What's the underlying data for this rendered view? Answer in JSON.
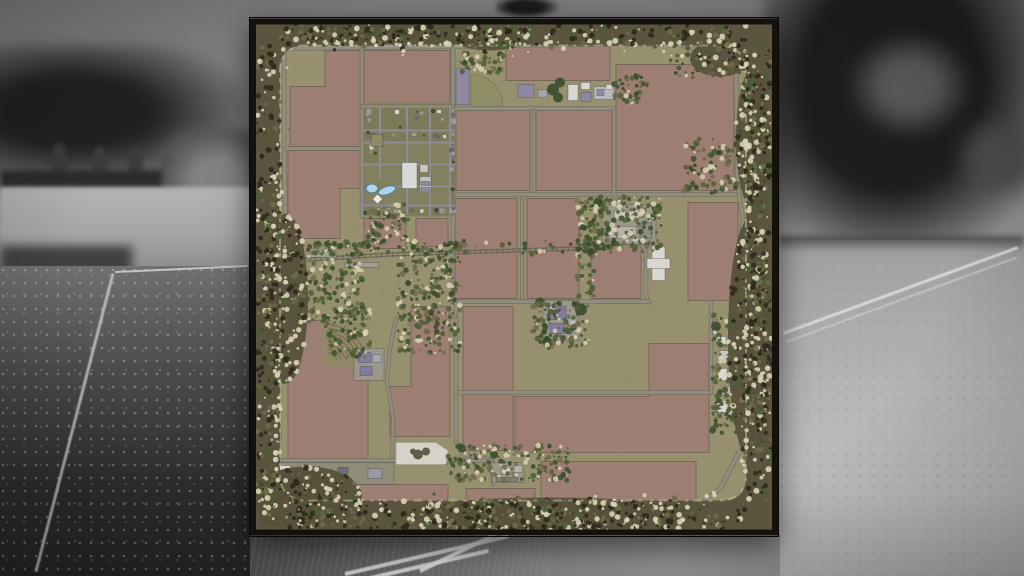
{
  "scene": {
    "type": "farming-simulator-map-preview",
    "background_photo": "grayscale countryside with trees, white fences and meadow",
    "visible_text": []
  },
  "map": {
    "colors": {
      "frame": "#15120e",
      "terrain": "#97906e",
      "field": "#9c7e72",
      "field_stroke": "#6e5f55",
      "road": "#908d80",
      "road_casing": "#6f6b5a",
      "street": "#8d8c96",
      "ring_base": "#57513c",
      "ring_dark": "#2f2a1c",
      "ring_green": "#4d5e34",
      "ring_olive": "#6e6a4a",
      "ring_cream": "#d8d2b4",
      "fringe": "#cfc9ac",
      "village_block": "#7c7a59",
      "pond": "#a9d6ea",
      "pond_stroke": "#557a8c",
      "forest": "#3a472a",
      "tree": "#3d5030",
      "quarry": "#d5d3c9",
      "quarry_blob": "#5f5b45",
      "pie_field": "#8f8e66",
      "rail": "#6b685c"
    },
    "frame": {
      "w": 528,
      "h": 517,
      "border": 6
    },
    "ring": {
      "inner": [
        30,
        27,
        466,
        455,
        24
      ],
      "band": {
        "t": 20,
        "r": 26,
        "b": 29,
        "l": 23
      },
      "speckles": 1150,
      "bulges": [
        [
          36,
          280,
          22,
          85
        ],
        [
          240,
          20,
          36,
          12
        ],
        [
          500,
          320,
          22,
          120
        ],
        [
          300,
          496,
          150,
          17
        ],
        [
          56,
          478,
          56,
          30
        ],
        [
          503,
          120,
          17,
          70
        ],
        [
          110,
          16,
          60,
          10
        ],
        [
          470,
          40,
          30,
          18
        ]
      ]
    },
    "fields": [
      {
        "pts": "75,32 112,32 112,128 40,128 40,68 75,68"
      },
      {
        "pts": "38,132 112,132 112,170 90,170 90,220 38,220"
      },
      {
        "rect": [
          114,
          32,
          86,
          54
        ]
      },
      {
        "rect": [
          256,
          28,
          104,
          34
        ]
      },
      {
        "rect": [
          366,
          46,
          118,
          126
        ]
      },
      {
        "rect": [
          206,
          92,
          74,
          80
        ]
      },
      {
        "rect": [
          286,
          92,
          76,
          80
        ]
      },
      {
        "rect": [
          114,
          200,
          42,
          30
        ]
      },
      {
        "rect": [
          166,
          200,
          32,
          28
        ]
      },
      {
        "rect": [
          205,
          180,
          62,
          100
        ]
      },
      {
        "rect": [
          277,
          180,
          52,
          100
        ]
      },
      {
        "rect": [
          341,
          226,
          50,
          54
        ]
      },
      {
        "rect": [
          438,
          184,
          50,
          98
        ]
      },
      {
        "pts": "38,302 80,302 80,326 118,326 118,445 38,445"
      },
      {
        "pts": "161,288 200,288 200,418 140,418 140,368 161,368"
      },
      {
        "rect": [
          213,
          288,
          50,
          144
        ]
      },
      {
        "rect": [
          96,
          466,
          102,
          24
        ]
      },
      {
        "rect": [
          216,
          470,
          69,
          22
        ]
      },
      {
        "pts": "399,325 459,325 459,434 265,434 265,378 399,378"
      },
      {
        "rect": [
          291,
          443,
          155,
          42
        ]
      }
    ],
    "pie_field": "M221,88 L221,56 A32,32 0 0 1 253,88 Z",
    "roads": [
      {
        "p": [
          [
            32,
            30
          ],
          [
            204,
            28
          ],
          [
            364,
            25
          ]
        ],
        "w": 3.4
      },
      {
        "p": [
          [
            364,
            25
          ],
          [
            430,
            26
          ],
          [
            470,
            38
          ],
          [
            486,
            54
          ],
          [
            488,
            170
          ]
        ],
        "w": 3.4
      },
      {
        "p": [
          [
            34,
            30
          ],
          [
            34,
            130
          ],
          [
            36,
            222
          ]
        ],
        "w": 3.4
      },
      {
        "p": [
          [
            36,
            130
          ],
          [
            112,
            130
          ]
        ],
        "w": 3
      },
      {
        "p": [
          [
            112,
            30
          ],
          [
            112,
            198
          ]
        ],
        "w": 3
      },
      {
        "p": [
          [
            203,
            30
          ],
          [
            203,
            284
          ]
        ],
        "w": 3.2
      },
      {
        "p": [
          [
            203,
            90
          ],
          [
            364,
            90
          ]
        ],
        "w": 3.2
      },
      {
        "p": [
          [
            284,
            92
          ],
          [
            284,
            176
          ]
        ],
        "w": 2.6
      },
      {
        "p": [
          [
            203,
            176
          ],
          [
            488,
            176
          ]
        ],
        "w": 3.2
      },
      {
        "p": [
          [
            364,
            92
          ],
          [
            364,
            176
          ],
          [
            371,
            184
          ],
          [
            386,
            212
          ],
          [
            396,
            234
          ],
          [
            396,
            278
          ],
          [
            399,
            284
          ]
        ],
        "w": 3
      },
      {
        "p": [
          [
            272,
            180
          ],
          [
            272,
            283
          ]
        ],
        "w": 2.4
      },
      {
        "p": [
          [
            203,
            283
          ],
          [
            399,
            283
          ]
        ],
        "w": 3
      },
      {
        "p": [
          [
            206,
            374
          ],
          [
            461,
            374
          ]
        ],
        "w": 3
      },
      {
        "p": [
          [
            461,
            283
          ],
          [
            461,
            374
          ]
        ],
        "w": 2.8
      },
      {
        "p": [
          [
            206,
            285
          ],
          [
            206,
            424
          ],
          [
            213,
            436
          ],
          [
            242,
            441
          ]
        ],
        "w": 2.8
      },
      {
        "p": [
          [
            146,
            300
          ],
          [
            140,
            330
          ],
          [
            137,
            362
          ],
          [
            143,
            400
          ],
          [
            142,
            442
          ]
        ],
        "w": 2.6
      },
      {
        "p": [
          [
            25,
            442
          ],
          [
            242,
            442
          ]
        ],
        "w": 3
      },
      {
        "p": [
          [
            60,
            490
          ],
          [
            200,
            492
          ],
          [
            290,
            489
          ],
          [
            448,
            487
          ],
          [
            471,
            469
          ],
          [
            491,
            430
          ],
          [
            492,
            290
          ]
        ],
        "w": 3.2
      },
      {
        "p": [
          [
            488,
            170
          ],
          [
            493,
            200
          ],
          [
            489,
            236
          ],
          [
            494,
            264
          ],
          [
            492,
            292
          ]
        ],
        "w": 2.8
      },
      {
        "p": [
          [
            22,
            222
          ],
          [
            30,
            250
          ],
          [
            24,
            284
          ],
          [
            31,
            332
          ],
          [
            22,
            374
          ],
          [
            30,
            416
          ],
          [
            25,
            442
          ]
        ],
        "w": 2.8
      },
      {
        "p": [
          [
            242,
            442
          ],
          [
            243,
            466
          ]
        ],
        "w": 2.2
      },
      {
        "p": [
          [
            112,
            88
          ],
          [
            203,
            88
          ]
        ],
        "w": 2.6
      }
    ],
    "village": {
      "base": [
        110,
        84,
        96,
        114
      ],
      "xs": [
        112,
        130,
        157,
        180,
        200,
        206
      ],
      "ys": [
        88,
        112,
        124,
        146,
        168,
        187,
        198
      ],
      "streets": [
        {
          "p": [
            [
              112,
              112
            ],
            [
              203,
              112
            ]
          ]
        },
        {
          "p": [
            [
              112,
              124
            ],
            [
              203,
              124
            ]
          ]
        },
        {
          "p": [
            [
              112,
              146
            ],
            [
              203,
              146
            ]
          ]
        },
        {
          "p": [
            [
              145,
              168
            ],
            [
              203,
              168
            ]
          ]
        },
        {
          "p": [
            [
              112,
              187
            ],
            [
              203,
              187
            ]
          ]
        },
        {
          "p": [
            [
              130,
              88
            ],
            [
              130,
              160
            ]
          ]
        },
        {
          "p": [
            [
              157,
              88
            ],
            [
              157,
              197
            ]
          ]
        },
        {
          "p": [
            [
              180,
              88
            ],
            [
              180,
              197
            ]
          ]
        },
        {
          "p": [
            [
              200,
              88
            ],
            [
              200,
              197
            ]
          ]
        },
        {
          "p": [
            [
              112,
              160
            ],
            [
              112,
              197
            ]
          ]
        }
      ],
      "skip_zones": [
        [
          148,
          140,
          34,
          36
        ],
        [
          113,
          158,
          36,
          22
        ]
      ]
    },
    "railway": {
      "p": [
        [
          16,
          244
        ],
        [
          60,
          241
        ],
        [
          140,
          236
        ],
        [
          360,
          229
        ]
      ],
      "gauge": 3,
      "tie_step": 5.5
    },
    "structures": [
      [
        268,
        66,
        16,
        13,
        "#8e88a4"
      ],
      [
        288,
        71,
        9,
        8,
        "#a5a3ab"
      ],
      [
        318,
        66,
        10,
        16,
        "#d8d7d2"
      ],
      [
        331,
        64,
        9,
        7,
        "#d8d7d2"
      ],
      [
        331,
        74,
        10,
        9,
        "#8e88a4"
      ],
      [
        344,
        68,
        20,
        13,
        "#b9b7bd"
      ],
      [
        347,
        71,
        7,
        6,
        "#8e88a4"
      ],
      [
        356,
        66,
        6,
        5,
        "#d8d7d2"
      ],
      [
        206,
        50,
        13,
        36,
        "#8e88a0"
      ],
      [
        352,
        186,
        54,
        40,
        "#9a9786"
      ],
      [
        360,
        208,
        26,
        12,
        "#b5b3a8"
      ],
      [
        390,
        204,
        12,
        16,
        "#8f8d80"
      ],
      [
        402,
        228,
        13,
        34,
        "#d9d8d0"
      ],
      [
        397,
        240,
        23,
        10,
        "#d9d8d0"
      ],
      [
        293,
        282,
        36,
        40,
        "#9b988b"
      ],
      [
        298,
        288,
        18,
        13,
        "#837ca0"
      ],
      [
        300,
        305,
        14,
        10,
        "#837ca0"
      ],
      [
        318,
        300,
        9,
        14,
        "#a9a7ae"
      ],
      [
        104,
        330,
        30,
        32,
        "#9b988b"
      ],
      [
        108,
        334,
        13,
        10,
        "#837ca0"
      ],
      [
        123,
        336,
        8,
        8,
        "#a9a7ae"
      ],
      [
        110,
        348,
        12,
        9,
        "#837ca0"
      ],
      [
        60,
        233,
        26,
        6,
        "#a09e93"
      ],
      [
        95,
        244,
        34,
        5,
        "#a09e93"
      ],
      [
        64,
        227,
        12,
        5,
        "#8e8c80"
      ],
      [
        24,
        444,
        120,
        22,
        "#8f8c78"
      ],
      [
        28,
        447,
        12,
        13,
        "#d8d7d2"
      ],
      [
        44,
        450,
        9,
        9,
        "#9a98a0"
      ],
      [
        57,
        448,
        13,
        11,
        "#837ca0"
      ],
      [
        74,
        451,
        9,
        8,
        "#a5a3ab"
      ],
      [
        88,
        449,
        10,
        10,
        "#6f6d75"
      ],
      [
        118,
        450,
        14,
        10,
        "#9a98a0"
      ],
      [
        242,
        444,
        32,
        20,
        "#9a9786"
      ],
      [
        246,
        459,
        22,
        4,
        "#7f7d72"
      ],
      [
        264,
        447,
        8,
        7,
        "#b5b3a8"
      ],
      [
        466,
        318,
        10,
        8,
        "#d8d7d2"
      ],
      [
        470,
        332,
        12,
        10,
        "#c6c4bb"
      ],
      [
        468,
        350,
        9,
        12,
        "#d8d7d2"
      ],
      [
        472,
        368,
        10,
        9,
        "#b5b3a8"
      ],
      [
        466,
        384,
        12,
        10,
        "#d8d7d2"
      ],
      [
        152,
        144,
        15,
        26,
        "#d9d8d4"
      ],
      [
        170,
        146,
        8,
        8,
        "#c9c7bf"
      ],
      [
        170,
        158,
        11,
        16,
        "#c4c2ba"
      ],
      [
        171,
        163,
        9,
        4,
        "#8e88a4"
      ],
      [
        171,
        169,
        9,
        4,
        "#8e88a4"
      ],
      [
        121,
        116,
        12,
        12,
        "#8f8a68"
      ]
    ],
    "tree_circles": [
      [
        303,
        71,
        6
      ],
      [
        310,
        64,
        5
      ],
      [
        308,
        79,
        5
      ],
      [
        290,
        284,
        5
      ],
      [
        331,
        291,
        6
      ],
      [
        297,
        323,
        5
      ],
      [
        348,
        184,
        5
      ],
      [
        407,
        190,
        5
      ],
      [
        352,
        228,
        4
      ],
      [
        466,
        308,
        5
      ],
      [
        482,
        396,
        5
      ],
      [
        244,
        436,
        4
      ],
      [
        212,
        430,
        4
      ]
    ],
    "tank_circles": [
      [
        370,
        196,
        6,
        "#c8c6bb"
      ],
      [
        384,
        196,
        6,
        "#c8c6bb"
      ],
      [
        256,
        452,
        4.5,
        "#d5d3c9"
      ]
    ],
    "pond": {
      "lobes": [
        {
          "cx": 122,
          "cy": 170,
          "rx": 6,
          "ry": 4.5,
          "rot": 0
        },
        {
          "cx": 137,
          "cy": 172,
          "rx": 9,
          "ry": 4,
          "rot": -18
        }
      ],
      "diamond": [
        124,
        177,
        7,
        7
      ]
    },
    "vineyard": {
      "base": [
        74,
        304,
        46,
        44
      ],
      "cx": 76,
      "cy": 346,
      "r0": 12,
      "dr": 4,
      "n": 8,
      "a0": -86,
      "a1": -18,
      "stroke": "#7e6b53"
    },
    "quarry": {
      "pts": "146,424 186,424 198,432 196,446 146,446",
      "blob": [
        [
          168,
          436,
          5
        ],
        [
          176,
          433,
          4
        ],
        [
          163,
          433,
          3
        ]
      ]
    },
    "forest": {
      "pts": "10,452 70,452 96,474 58,508 10,508",
      "spk_ellipse": [
        50,
        480,
        46,
        27,
        140
      ]
    },
    "veg_patches": [
      [
        42,
        225,
        72,
        80,
        210
      ],
      [
        148,
        224,
        62,
        112,
        260
      ],
      [
        118,
        186,
        40,
        36,
        60
      ],
      [
        336,
        178,
        76,
        56,
        180
      ],
      [
        282,
        284,
        58,
        46,
        120
      ],
      [
        462,
        296,
        40,
        120,
        200
      ],
      [
        196,
        426,
        126,
        36,
        170
      ],
      [
        74,
        288,
        48,
        52,
        90
      ],
      [
        210,
        34,
        44,
        20,
        50
      ],
      [
        326,
        182,
        20,
        96,
        70
      ],
      [
        434,
        120,
        54,
        56,
        90
      ],
      [
        364,
        56,
        34,
        30,
        50
      ],
      [
        60,
        222,
        300,
        14,
        90
      ],
      [
        420,
        34,
        70,
        26,
        60
      ]
    ],
    "terrain_noise": 420
  }
}
